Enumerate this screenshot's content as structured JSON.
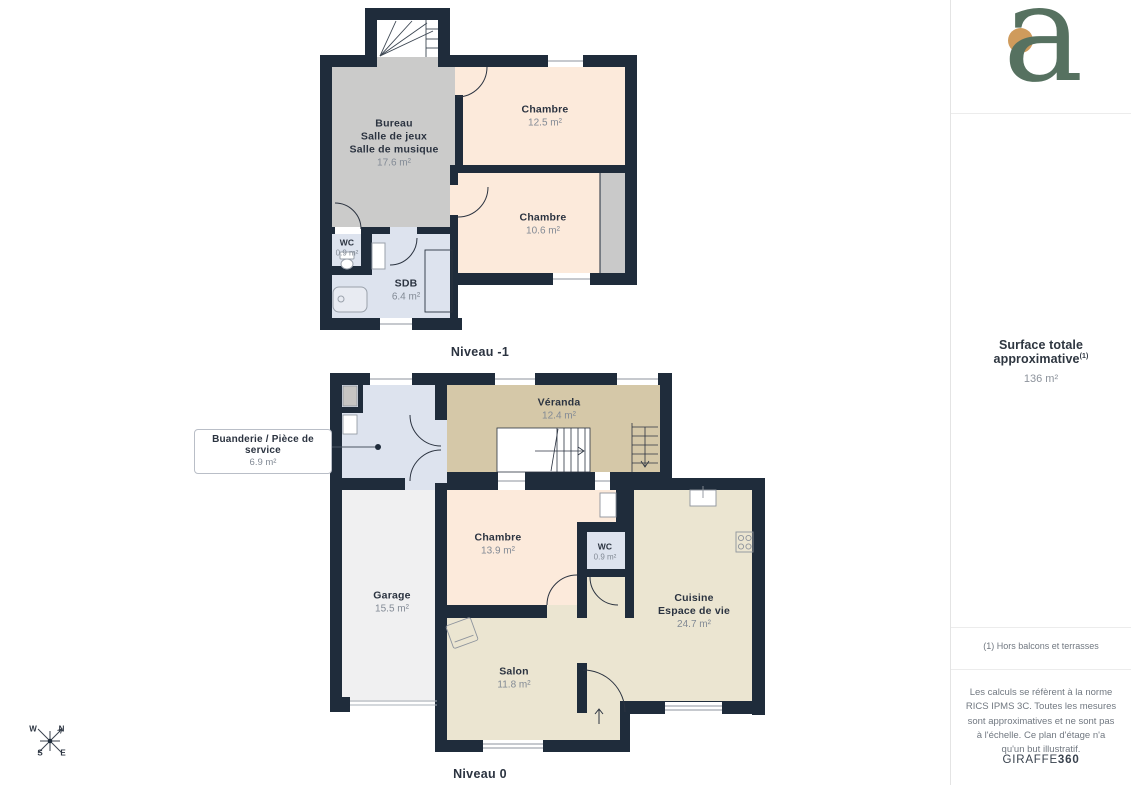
{
  "colors": {
    "wall": "#1f2c3b",
    "room_peach": "#fceadb",
    "room_gray": "#cbcbca",
    "room_closet": "#c9c9c9",
    "room_blue": "#dde3ee",
    "room_tan": "#d5c8a8",
    "room_cream": "#ebe5d1",
    "room_garage": "#f0f0f1",
    "logo_green": "#567160",
    "logo_orange": "#cf9b5c",
    "label_dark": "#2b3340",
    "label_gray": "#828a95"
  },
  "plans": {
    "level_minus1": {
      "title": "Niveau -1",
      "rooms": {
        "bureau": {
          "name": "Bureau\nSalle de jeux\nSalle de musique",
          "area": "17.6 m²"
        },
        "chambre1": {
          "name": "Chambre",
          "area": "12.5 m²"
        },
        "chambre2": {
          "name": "Chambre",
          "area": "10.6 m²"
        },
        "wc": {
          "name": "WC",
          "area": "0.9 m²"
        },
        "sdb": {
          "name": "SDB",
          "area": "6.4 m²"
        }
      }
    },
    "level_0": {
      "title": "Niveau 0",
      "rooms": {
        "buanderie": {
          "name": "Buanderie / Pièce de service",
          "area": "6.9 m²"
        },
        "veranda": {
          "name": "Véranda",
          "area": "12.4 m²"
        },
        "chambre": {
          "name": "Chambre",
          "area": "13.9 m²"
        },
        "wc": {
          "name": "WC",
          "area": "0.9 m²"
        },
        "garage": {
          "name": "Garage",
          "area": "15.5 m²"
        },
        "cuisine": {
          "name": "Cuisine\nEspace de vie",
          "area": "24.7 m²"
        },
        "salon": {
          "name": "Salon",
          "area": "11.8 m²"
        }
      }
    }
  },
  "compass": {
    "west": "W",
    "north": "N",
    "south": "S",
    "east": "E"
  },
  "sidebar": {
    "logo_letter": "a",
    "surface_title": "Surface totale approximative",
    "surface_superscript": "(1)",
    "surface_value": "136 m²",
    "footnote": "(1) Hors balcons et terrasses",
    "disclaimer": "Les calculs se réfèrent à la norme RICS IPMS 3C. Toutes les mesures sont approximatives et ne sont pas à l'échelle. Ce plan d'étage n'a qu'un but illustratif.",
    "brand_name": "GIRAFFE",
    "brand_number": "360"
  }
}
